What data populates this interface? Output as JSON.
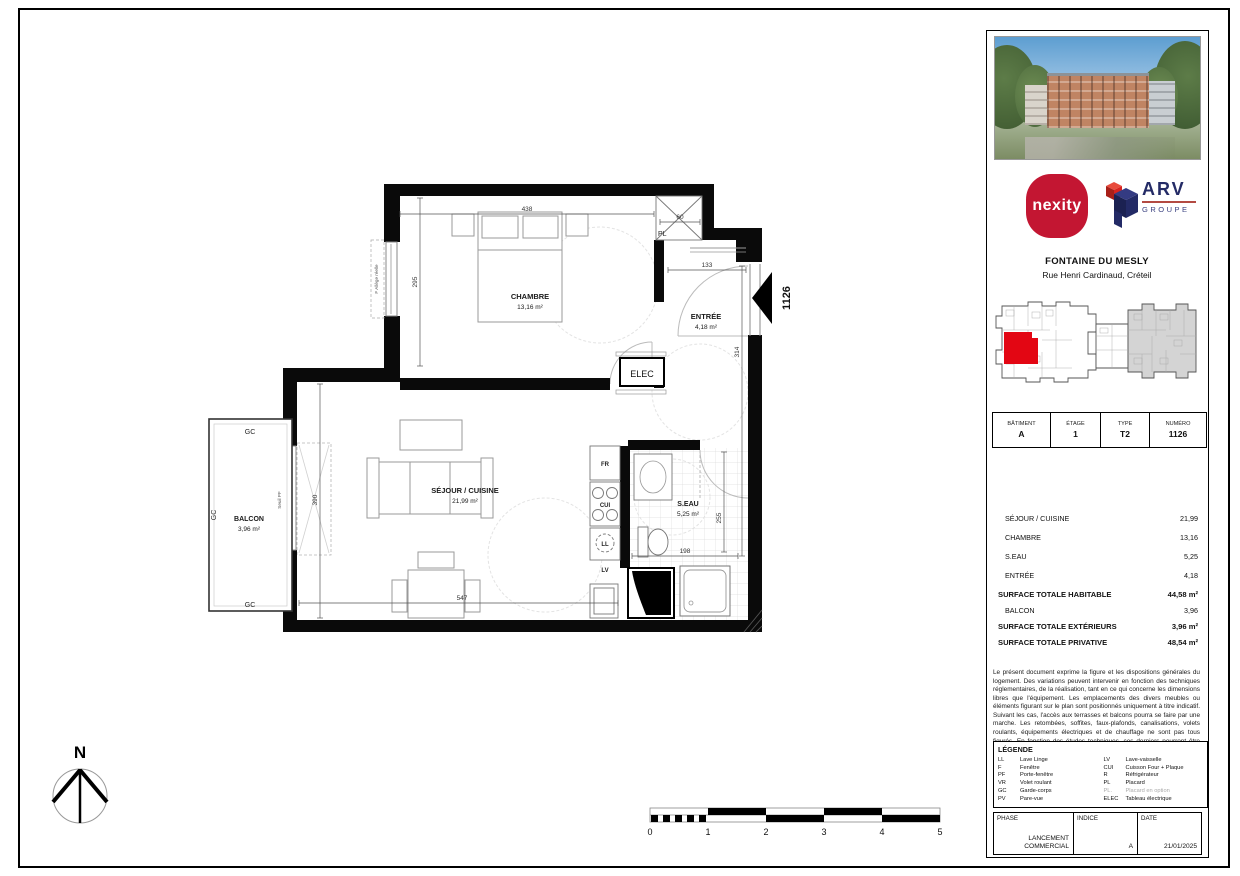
{
  "plan": {
    "rooms": {
      "chambre": {
        "name": "CHAMBRE",
        "area": "13,16 m²"
      },
      "entree": {
        "name": "ENTRÉE",
        "area": "4,18 m²"
      },
      "sejour": {
        "name": "SÉJOUR / CUISINE",
        "area": "21,99 m²"
      },
      "seau": {
        "name": "S.EAU",
        "area": "5,25 m²"
      },
      "balcon": {
        "name": "BALCON",
        "area": "3,96 m²"
      }
    },
    "labels": {
      "elec": "ELEC",
      "pl": "PL",
      "fr": "FR",
      "cui": "CUI",
      "ll": "LL",
      "lv": "LV",
      "gc": "GC",
      "seuil_pf": "Seuil PF",
      "allege": "F Allège réelle",
      "unit": "1126",
      "north": "N"
    },
    "dims": {
      "chambre_w": "438",
      "pl_w": "60",
      "chambre_h": "295",
      "entree_w": "133",
      "entree_h": "314",
      "sejour_h": "390",
      "sejour_w": "547",
      "seau_w": "198",
      "seau_h": "255"
    },
    "scale": {
      "t0": "0",
      "t1": "1",
      "t2": "2",
      "t3": "3",
      "t4": "4",
      "t5": "5"
    }
  },
  "sidebar": {
    "developer_logo": "nexity",
    "partner_logo": {
      "name": "ARV",
      "sub": "GROUPE"
    },
    "project": {
      "name": "FONTAINE DU MESLY",
      "address": "Rue Henri Cardinaud, Créteil"
    },
    "unit_table": {
      "headers": [
        "BÂTIMENT",
        "ÉTAGE",
        "TYPE",
        "NUMÉRO"
      ],
      "values": [
        "A",
        "1",
        "T2",
        "1126"
      ]
    },
    "surfaces": {
      "rows": [
        {
          "label": "SÉJOUR / CUISINE",
          "value": "21,99"
        },
        {
          "label": "CHAMBRE",
          "value": "13,16"
        },
        {
          "label": "S.EAU",
          "value": "5,25"
        },
        {
          "label": "ENTRÉE",
          "value": "4,18"
        }
      ],
      "total_habitable": {
        "label": "SURFACE TOTALE HABITABLE",
        "value": "44,58 m²"
      },
      "balcon": {
        "label": "BALCON",
        "value": "3,96"
      },
      "total_exterieurs": {
        "label": "SURFACE TOTALE EXTÉRIEURS",
        "value": "3,96 m²"
      },
      "total_privative": {
        "label": "SURFACE TOTALE PRIVATIVE",
        "value": "48,54 m²"
      }
    },
    "disclaimer": "Le présent document exprime la figure et les dispositions générales du logement. Des variations peuvent intervenir en fonction des techniques réglementaires, de la réalisation, tant en ce qui concerne les dimensions libres que l'équipement. Les emplacements des divers meubles ou éléments figurant sur le plan sont positionnés uniquement à titre indicatif. Suivant les cas, l'accès aux terrasses et balcons pourra se faire par une marche. Les retombées, soffites, faux-plafonds, canalisations, volets roulants, équipements électriques et de chauffage ne sont pas tous figurés. En fonction des études techniques, ces derniers pourront être rajoutés, déplacés ou supprimés. Les placards sont compris dans les surfaces des pièces. La végétation n'est pas contractuelle.",
    "legend": {
      "title": "LÉGENDE",
      "left": [
        [
          "LL",
          "Lave Linge"
        ],
        [
          "F",
          "Fenêtre"
        ],
        [
          "PF",
          "Porte-fenêtre"
        ],
        [
          "VR",
          "Volet roulant"
        ],
        [
          "GC",
          "Garde-corps"
        ],
        [
          "PV",
          "Pare-vue"
        ]
      ],
      "right": [
        [
          "LV",
          "Lave-vaisselle"
        ],
        [
          "CUI",
          "Cuisson Four + Plaque"
        ],
        [
          "R",
          "Réfrigérateur"
        ],
        [
          "PL",
          "Placard"
        ],
        [
          "PL.",
          "Placard en option"
        ],
        [
          "ELEC",
          "Tableau électrique"
        ]
      ]
    },
    "phase_table": {
      "phase_label": "PHASE",
      "phase_value_1": "LANCEMENT",
      "phase_value_2": "COMMERCIAL",
      "indice_label": "INDICE",
      "indice_value": "A",
      "date_label": "DATE",
      "date_value": "21/01/2025"
    }
  },
  "colors": {
    "nexity_red": "#c31632",
    "arv_blue": "#242b66",
    "unit_red": "#e30613"
  }
}
